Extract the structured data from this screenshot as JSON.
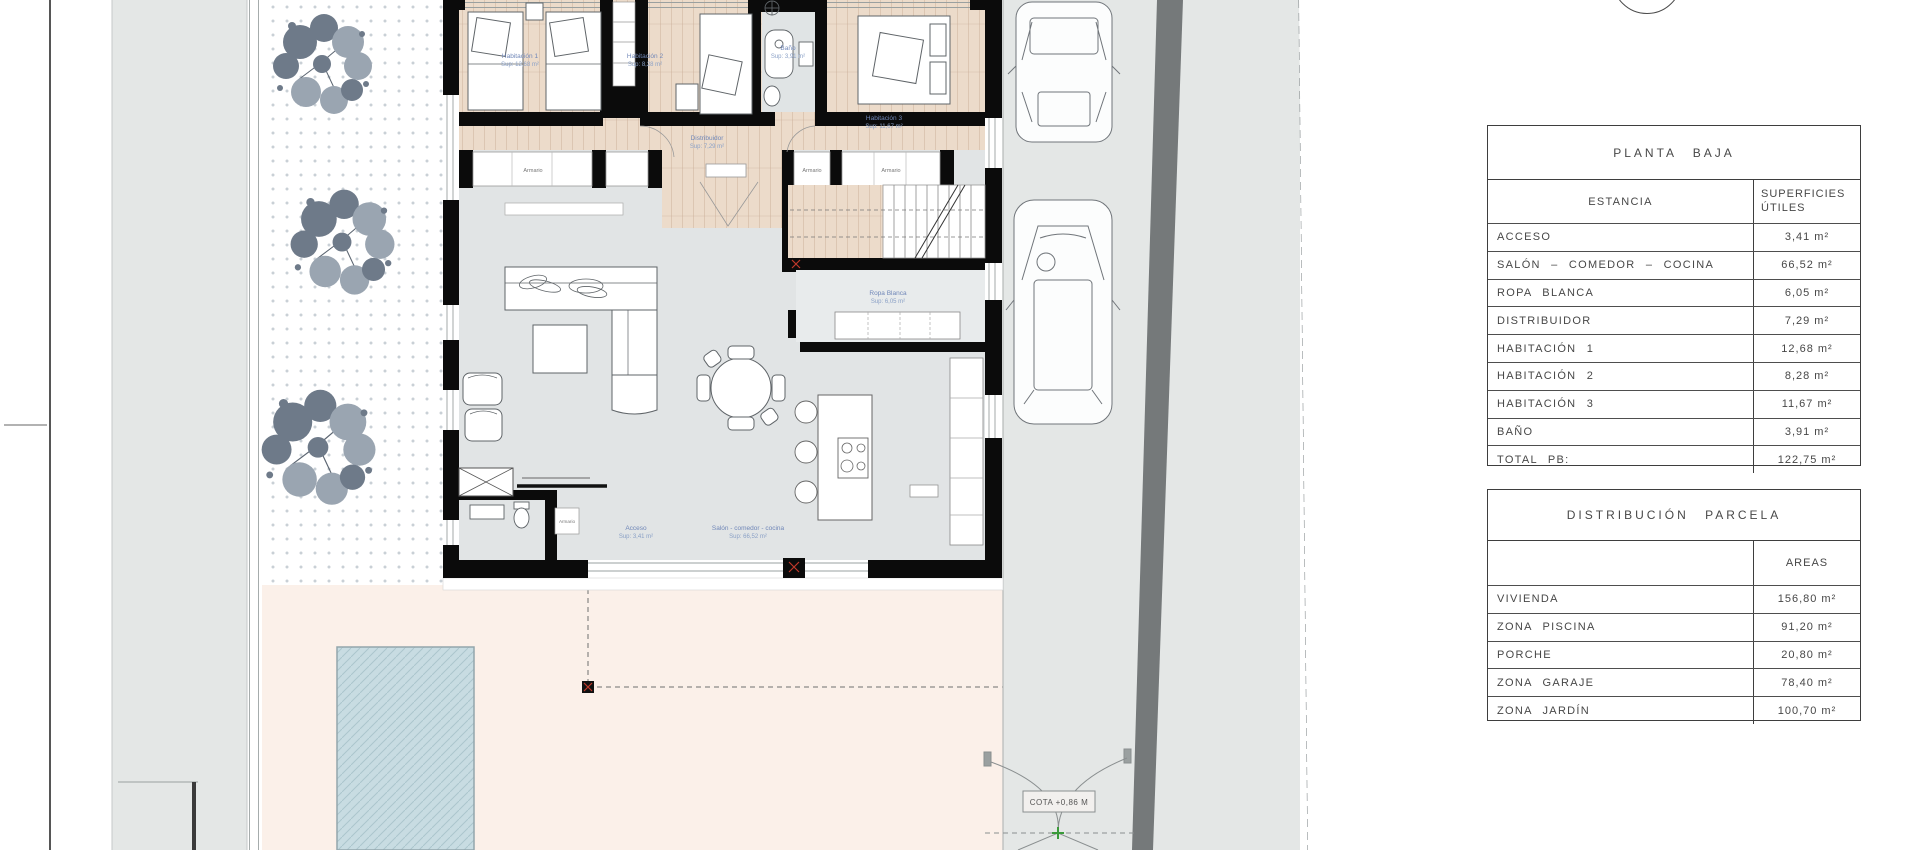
{
  "plan": {
    "room_labels": [
      {
        "name": "Habitación 1",
        "sup": "Sup: 12,68 m²"
      },
      {
        "name": "Habitación 2",
        "sup": "Sup: 8,28 m²"
      },
      {
        "name": "Habitación 3",
        "sup": "Sup: 11,67 m²"
      },
      {
        "name": "Baño",
        "sup": "Sup: 3,91 m²"
      },
      {
        "name": "Distribuidor",
        "sup": "Sup: 7,29 m²"
      },
      {
        "name": "Ropa Blanca",
        "sup": "Sup: 6,05 m²"
      },
      {
        "name": "Acceso",
        "sup": "Sup: 3,41 m²"
      },
      {
        "name": "Salón - comedor - cocina",
        "sup": "Sup: 66,52 m²"
      }
    ],
    "closet_label": "Armario",
    "gate_cota": "COTA +0,86 M"
  },
  "tables": {
    "planta_baja": {
      "title": "PLANTA BAJA",
      "estancia_header": "ESTANCIA",
      "superficies_header_1": "SUPERFICIES",
      "superficies_header_2": "ÚTILES",
      "rows": [
        {
          "estancia": "ACCESO",
          "valor": "3,41 m²"
        },
        {
          "estancia": "SALÓN – COMEDOR – COCINA",
          "valor": "66,52 m²"
        },
        {
          "estancia": "ROPA BLANCA",
          "valor": "6,05 m²"
        },
        {
          "estancia": "DISTRIBUIDOR",
          "valor": "7,29 m²"
        },
        {
          "estancia": "HABITACIÓN 1",
          "valor": "12,68 m²"
        },
        {
          "estancia": "HABITACIÓN 2",
          "valor": "8,28 m²"
        },
        {
          "estancia": "HABITACIÓN 3",
          "valor": "11,67 m²"
        },
        {
          "estancia": "BAÑO",
          "valor": "3,91 m²"
        },
        {
          "estancia": "TOTAL PB:",
          "valor": "122,75 m²"
        }
      ]
    },
    "distribucion_parcela": {
      "title": "DISTRIBUCIÓN PARCELA",
      "areas_header": "AREAS",
      "rows": [
        {
          "zona": "VIVIENDA",
          "valor": "156,80 m²"
        },
        {
          "zona": "ZONA PISCINA",
          "valor": "91,20 m²"
        },
        {
          "zona": "PORCHE",
          "valor": "20,80 m²"
        },
        {
          "zona": "ZONA GARAJE",
          "valor": "78,40 m²"
        },
        {
          "zona": "ZONA JARDÍN",
          "valor": "100,70 m²"
        }
      ]
    }
  },
  "colors": {
    "road_gray": "#e4e7e6",
    "salon_gray": "#e1e4e5",
    "wood": "#ecdbca",
    "terrace_pink": "#fbf0e9",
    "pool_blue": "#c8dce2",
    "wall_black": "#0b0b0b",
    "band_gray": "#75797a",
    "label_blue": "#7087b8"
  }
}
